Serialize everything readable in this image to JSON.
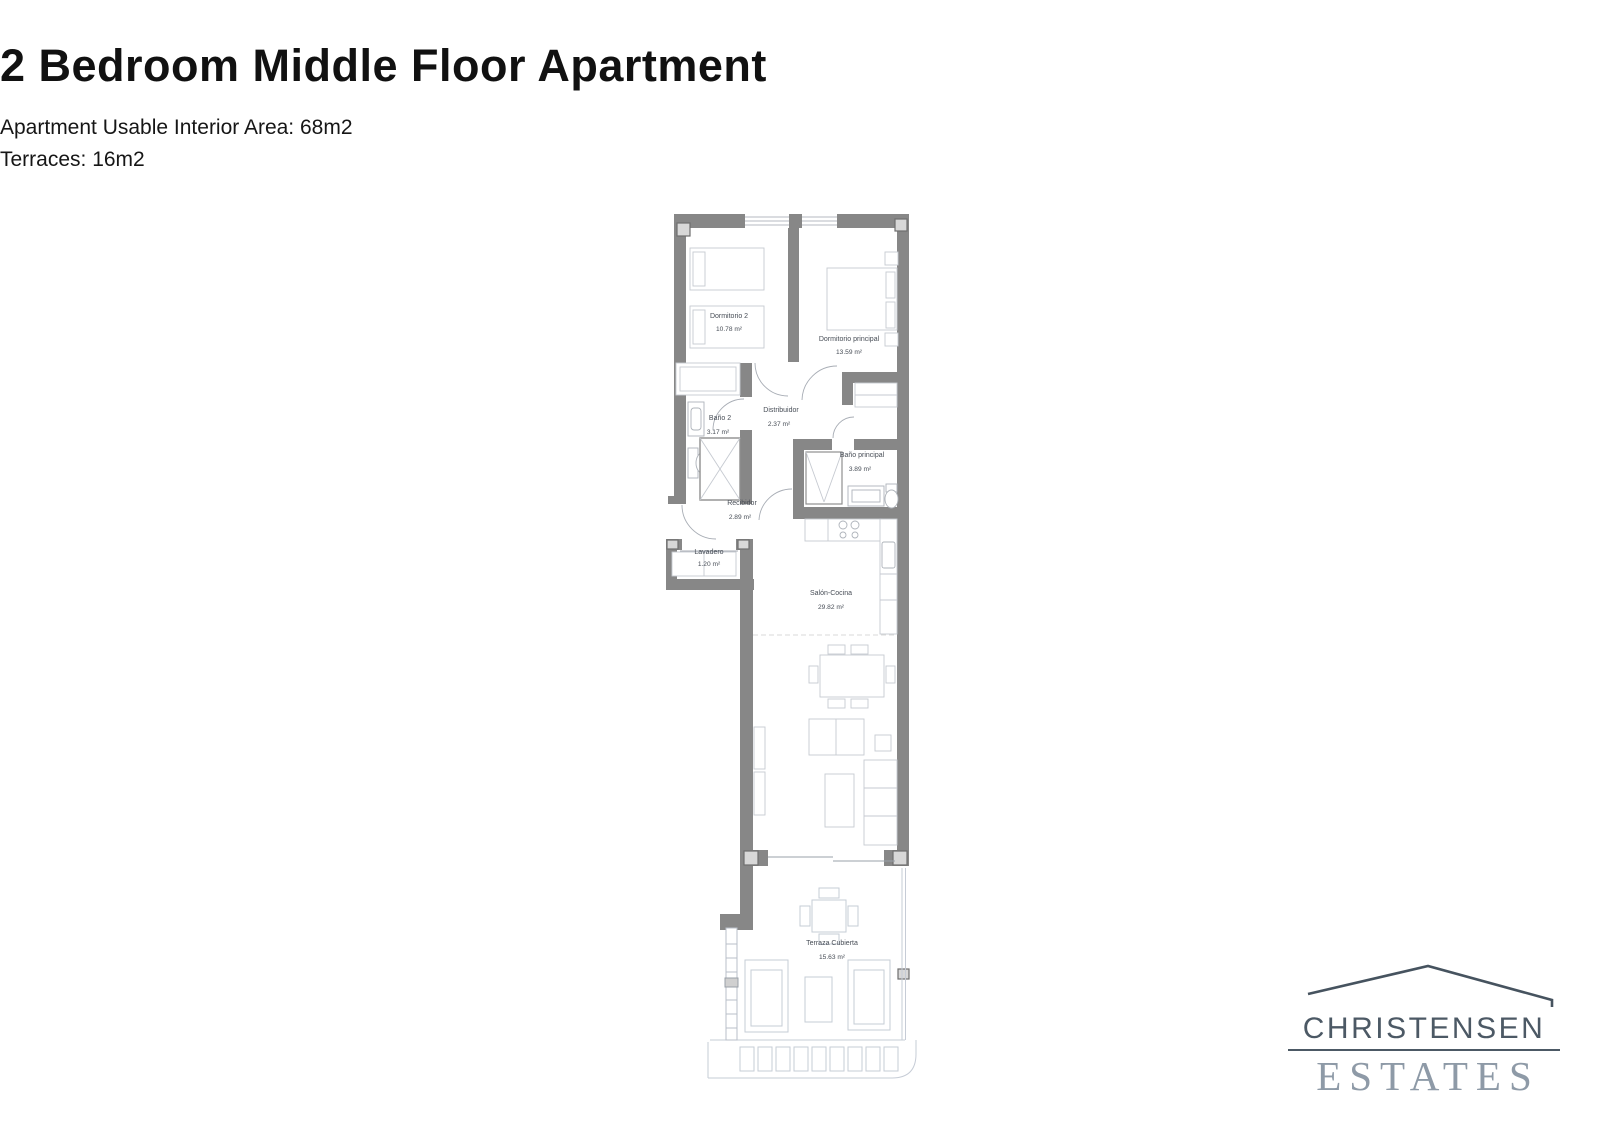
{
  "header": {
    "title": "2 Bedroom Middle Floor Apartment",
    "subtitle_line1": "Apartment Usable Interior Area: 68m2",
    "subtitle_line2": "Terraces: 16m2"
  },
  "floor_plan": {
    "rooms": {
      "dormitorio_2": {
        "name": "Dormitorio 2",
        "area": "10.78 m²"
      },
      "dormitorio_principal": {
        "name": "Dormitorio principal",
        "area": "13.59 m²"
      },
      "bano_2": {
        "name": "Baño 2",
        "area": "3.17 m²"
      },
      "distribuidor": {
        "name": "Distribuidor",
        "area": "2.37 m²"
      },
      "bano_principal": {
        "name": "Baño principal",
        "area": "3.89 m²"
      },
      "recibidor": {
        "name": "Recibidor",
        "area": "2.89 m²"
      },
      "lavadero": {
        "name": "Lavadero",
        "area": "1.20 m²"
      },
      "salon_cocina": {
        "name": "Salón-Cocina",
        "area": "29.82 m²"
      },
      "terraza_cubierta": {
        "name": "Terraza Cubierta",
        "area": "15.63 m²"
      }
    },
    "colors": {
      "wall": "#878787",
      "furniture_outline": "#c6cad1",
      "label": "#474d56"
    }
  },
  "logo": {
    "name_top": "CHRISTENSEN",
    "name_bottom": "ESTATES",
    "color_primary": "#4c5965",
    "color_secondary": "#8e9aa7"
  }
}
